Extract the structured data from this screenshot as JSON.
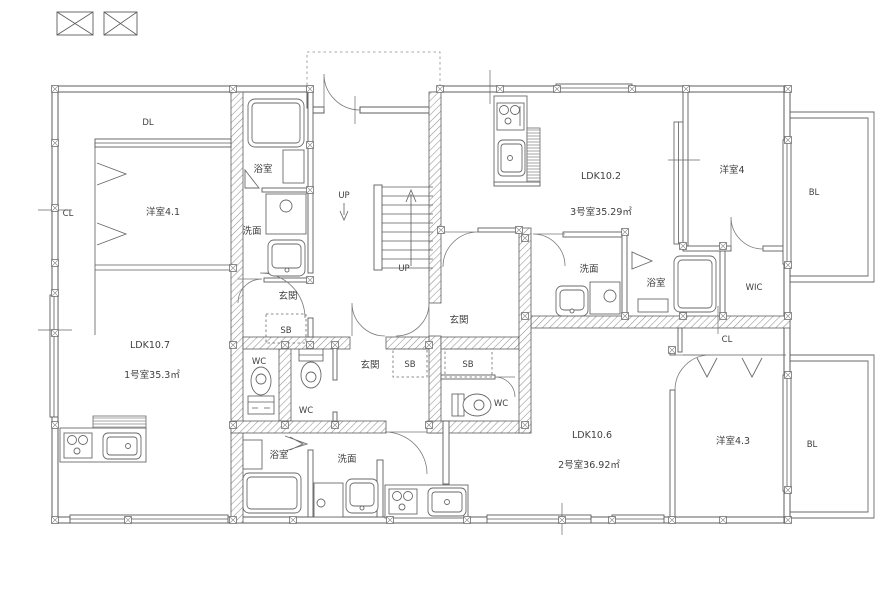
{
  "units": [
    {
      "name": "1号室",
      "area_label": "1号室35.3㎡",
      "ldk_label": "LDK10.7",
      "rooms": [
        "洋室4.1",
        "浴室",
        "洗面",
        "玄関",
        "WC",
        "CL",
        "DL",
        "SB"
      ]
    },
    {
      "name": "2号室",
      "area_label": "2号室36.92㎡",
      "ldk_label": "LDK10.6",
      "rooms": [
        "洋室4.3",
        "浴室",
        "洗面",
        "玄関",
        "WC",
        "CL",
        "BL",
        "SB"
      ]
    },
    {
      "name": "3号室",
      "area_label": "3号室35.29㎡",
      "ldk_label": "LDK10.2",
      "rooms": [
        "洋室4",
        "浴室",
        "洗面",
        "玄関",
        "WC",
        "WIC",
        "BL",
        "SB"
      ]
    }
  ],
  "stairs": {
    "labels": [
      "UP",
      "UP"
    ]
  },
  "labels": [
    {
      "text": "DL"
    },
    {
      "text": "CL"
    },
    {
      "text": "洋室4.1"
    },
    {
      "text": "浴室"
    },
    {
      "text": "洗面"
    },
    {
      "text": "玄関"
    },
    {
      "text": "SB"
    },
    {
      "text": "WC"
    },
    {
      "text": "LDK10.7"
    },
    {
      "text": "1号室35.3㎡"
    },
    {
      "text": "UP"
    },
    {
      "text": "UP"
    },
    {
      "text": "LDK10.2"
    },
    {
      "text": "3号室35.29㎡"
    },
    {
      "text": "洋室4"
    },
    {
      "text": "BL"
    },
    {
      "text": "洗面"
    },
    {
      "text": "浴室"
    },
    {
      "text": "WIC"
    },
    {
      "text": "玄関"
    },
    {
      "text": "SB"
    },
    {
      "text": "WC"
    },
    {
      "text": "玄関"
    },
    {
      "text": "SB"
    },
    {
      "text": "WC"
    },
    {
      "text": "浴室"
    },
    {
      "text": "洗面"
    },
    {
      "text": "LDK10.6"
    },
    {
      "text": "2号室36.92㎡"
    },
    {
      "text": "洋室4.3"
    },
    {
      "text": "CL"
    },
    {
      "text": "BL"
    }
  ]
}
